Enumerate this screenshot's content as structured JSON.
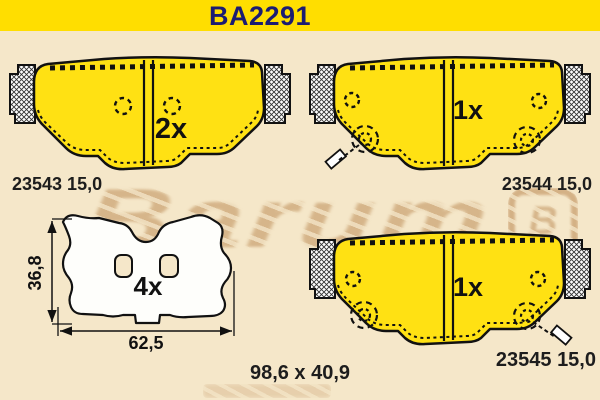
{
  "header": {
    "title": "BA2291"
  },
  "colors": {
    "header_bg": "#FFDE00",
    "title_text": "#1C1C72",
    "background": "#F5E7C9",
    "pad_yellow": "#FFE113",
    "outline": "#111111",
    "watermark": "#C19461"
  },
  "watermark": {
    "brand": "Barum",
    "logo_letter": "B"
  },
  "pads": [
    {
      "name": "pad-top-left",
      "quantity": "2x",
      "part_number": "23543 15,0"
    },
    {
      "name": "pad-top-right",
      "quantity": "1x",
      "part_number": "23544 15,0"
    },
    {
      "name": "pad-bottom-right",
      "quantity": "1x",
      "part_number": "23545 15,0"
    }
  ],
  "shim": {
    "quantity": "4x",
    "height_label": "36,8",
    "width_label": "62,5"
  },
  "overall_size_label": "98,6 x 40,9"
}
